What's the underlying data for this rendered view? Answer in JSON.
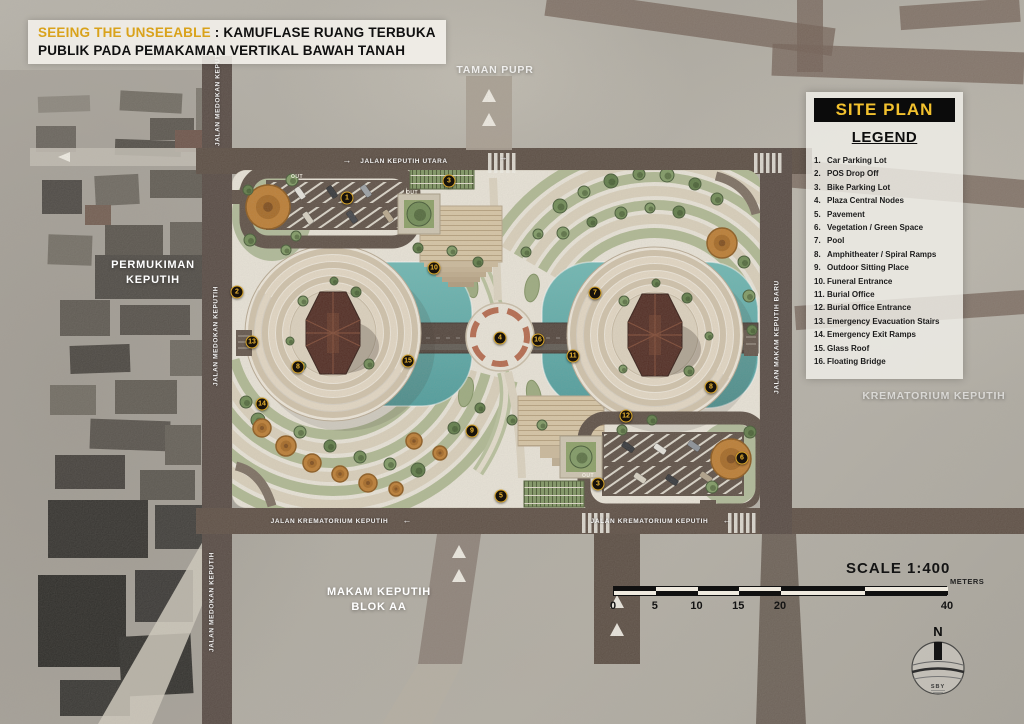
{
  "title": {
    "highlight": "SEEING THE UNSEEABLE",
    "separator": " : ",
    "line1_rest": "KAMUFLASE RUANG TERBUKA",
    "line2": "PUBLIK PADA PEMAKAMAN VERTIKAL BAWAH TANAH"
  },
  "panel": {
    "title": "SITE PLAN",
    "legend_title": "LEGEND",
    "items": [
      {
        "num": "1.",
        "label": "Car Parking Lot"
      },
      {
        "num": "2.",
        "label": "POS Drop Off"
      },
      {
        "num": "3.",
        "label": "Bike Parking Lot"
      },
      {
        "num": "4.",
        "label": "Plaza Central Nodes"
      },
      {
        "num": "5.",
        "label": "Pavement"
      },
      {
        "num": "6.",
        "label": "Vegetation / Green Space"
      },
      {
        "num": "7.",
        "label": "Pool"
      },
      {
        "num": "8.",
        "label": "Amphitheater / Spiral Ramps"
      },
      {
        "num": "9.",
        "label": "Outdoor Sitting Place"
      },
      {
        "num": "10.",
        "label": "Funeral Entrance"
      },
      {
        "num": "11.",
        "label": "Burial Office"
      },
      {
        "num": "12.",
        "label": "Burial Office Entrance"
      },
      {
        "num": "13.",
        "label": "Emergency Evacuation Stairs"
      },
      {
        "num": "14.",
        "label": "Emergency Exit Ramps"
      },
      {
        "num": "15.",
        "label": "Glass Roof"
      },
      {
        "num": "16.",
        "label": "Floating Bridge"
      }
    ]
  },
  "area_labels": {
    "taman_pupr": "TAMAN PUPR",
    "permukiman": "PERMUKIMAN KEPUTIH",
    "krematorium": "KREMATORIUM KEPUTIH",
    "makam": "MAKAM KEPUTIH BLOK AA"
  },
  "streets": [
    {
      "id": "keputih-utara",
      "text": "JALAN KEPUTIH UTARA"
    },
    {
      "id": "medokan-keputih",
      "text": "JALAN MEDOKAN KEPUTIH"
    },
    {
      "id": "makam-keputih-baru",
      "text": "JALAN MAKAM KEPUTIH BARU"
    },
    {
      "id": "krematorium-keputih",
      "text": "JALAN KREMATORIUM KEPUTIH"
    }
  ],
  "road_markings": {
    "out": "OUT"
  },
  "markers": [
    {
      "n": "1",
      "x": 347,
      "y": 198
    },
    {
      "n": "2",
      "x": 237,
      "y": 292
    },
    {
      "n": "3",
      "x": 449,
      "y": 181
    },
    {
      "n": "3",
      "x": 598,
      "y": 484
    },
    {
      "n": "4",
      "x": 500,
      "y": 338
    },
    {
      "n": "5",
      "x": 501,
      "y": 496
    },
    {
      "n": "6",
      "x": 742,
      "y": 458
    },
    {
      "n": "7",
      "x": 595,
      "y": 293
    },
    {
      "n": "8",
      "x": 298,
      "y": 367
    },
    {
      "n": "8",
      "x": 711,
      "y": 387
    },
    {
      "n": "9",
      "x": 472,
      "y": 431
    },
    {
      "n": "10",
      "x": 434,
      "y": 268
    },
    {
      "n": "11",
      "x": 573,
      "y": 356
    },
    {
      "n": "12",
      "x": 626,
      "y": 416
    },
    {
      "n": "13",
      "x": 252,
      "y": 342
    },
    {
      "n": "14",
      "x": 262,
      "y": 404
    },
    {
      "n": "15",
      "x": 408,
      "y": 361
    },
    {
      "n": "16",
      "x": 538,
      "y": 340
    }
  ],
  "scale": {
    "title": "SCALE  1:400",
    "units": "METERS",
    "ticks": [
      "0",
      "5",
      "10",
      "15",
      "20",
      "40"
    ]
  },
  "compass": {
    "north": "N",
    "label": "SBY"
  },
  "colors": {
    "title_yellow": "#d9a21b",
    "panel_yellow": "#f2c12e",
    "road_brown": "#57493f",
    "pool_teal": "#55a8a6",
    "pavement": "#ece7db",
    "vegetation_green": "#7d9560",
    "marker_ring": "#d9a62a"
  }
}
